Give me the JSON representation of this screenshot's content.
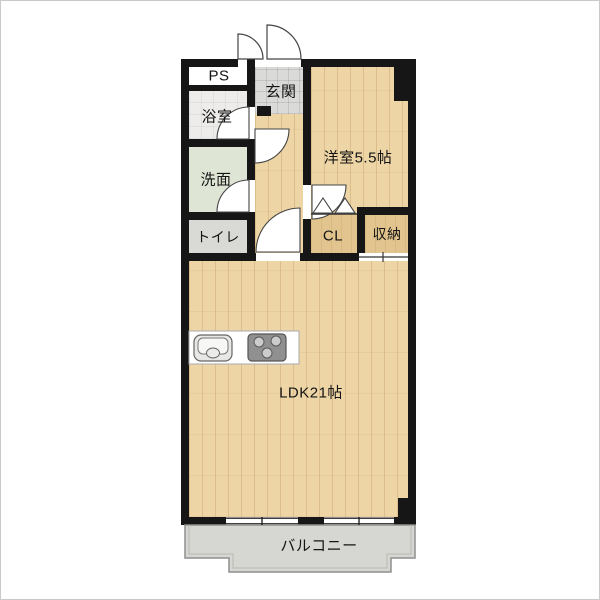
{
  "floorplan": {
    "type": "japanese-apartment-floor-plan",
    "rooms": {
      "ps": {
        "label": "PS"
      },
      "bath": {
        "label": "浴室"
      },
      "washroom": {
        "label": "洗面"
      },
      "toilet": {
        "label": "トイレ"
      },
      "entrance": {
        "label": "玄関"
      },
      "western": {
        "label": "洋室5.5帖"
      },
      "closet": {
        "label": "CL"
      },
      "storage": {
        "label": "収納"
      },
      "ldk": {
        "label": "LDK21帖"
      },
      "balcony": {
        "label": "バルコニー"
      }
    },
    "colors": {
      "wall": "#161616",
      "wood_floor": "#edd5a6",
      "entrance_tile": "#dadad8",
      "bath": "#edecea",
      "washroom": "#dfe5d5",
      "toilet": "#d9d9d5",
      "closet": "#e2c48e",
      "balcony": "#d6d6d2",
      "fixture_stove": "#909090",
      "fixture_sink": "#e8e8e6"
    }
  }
}
